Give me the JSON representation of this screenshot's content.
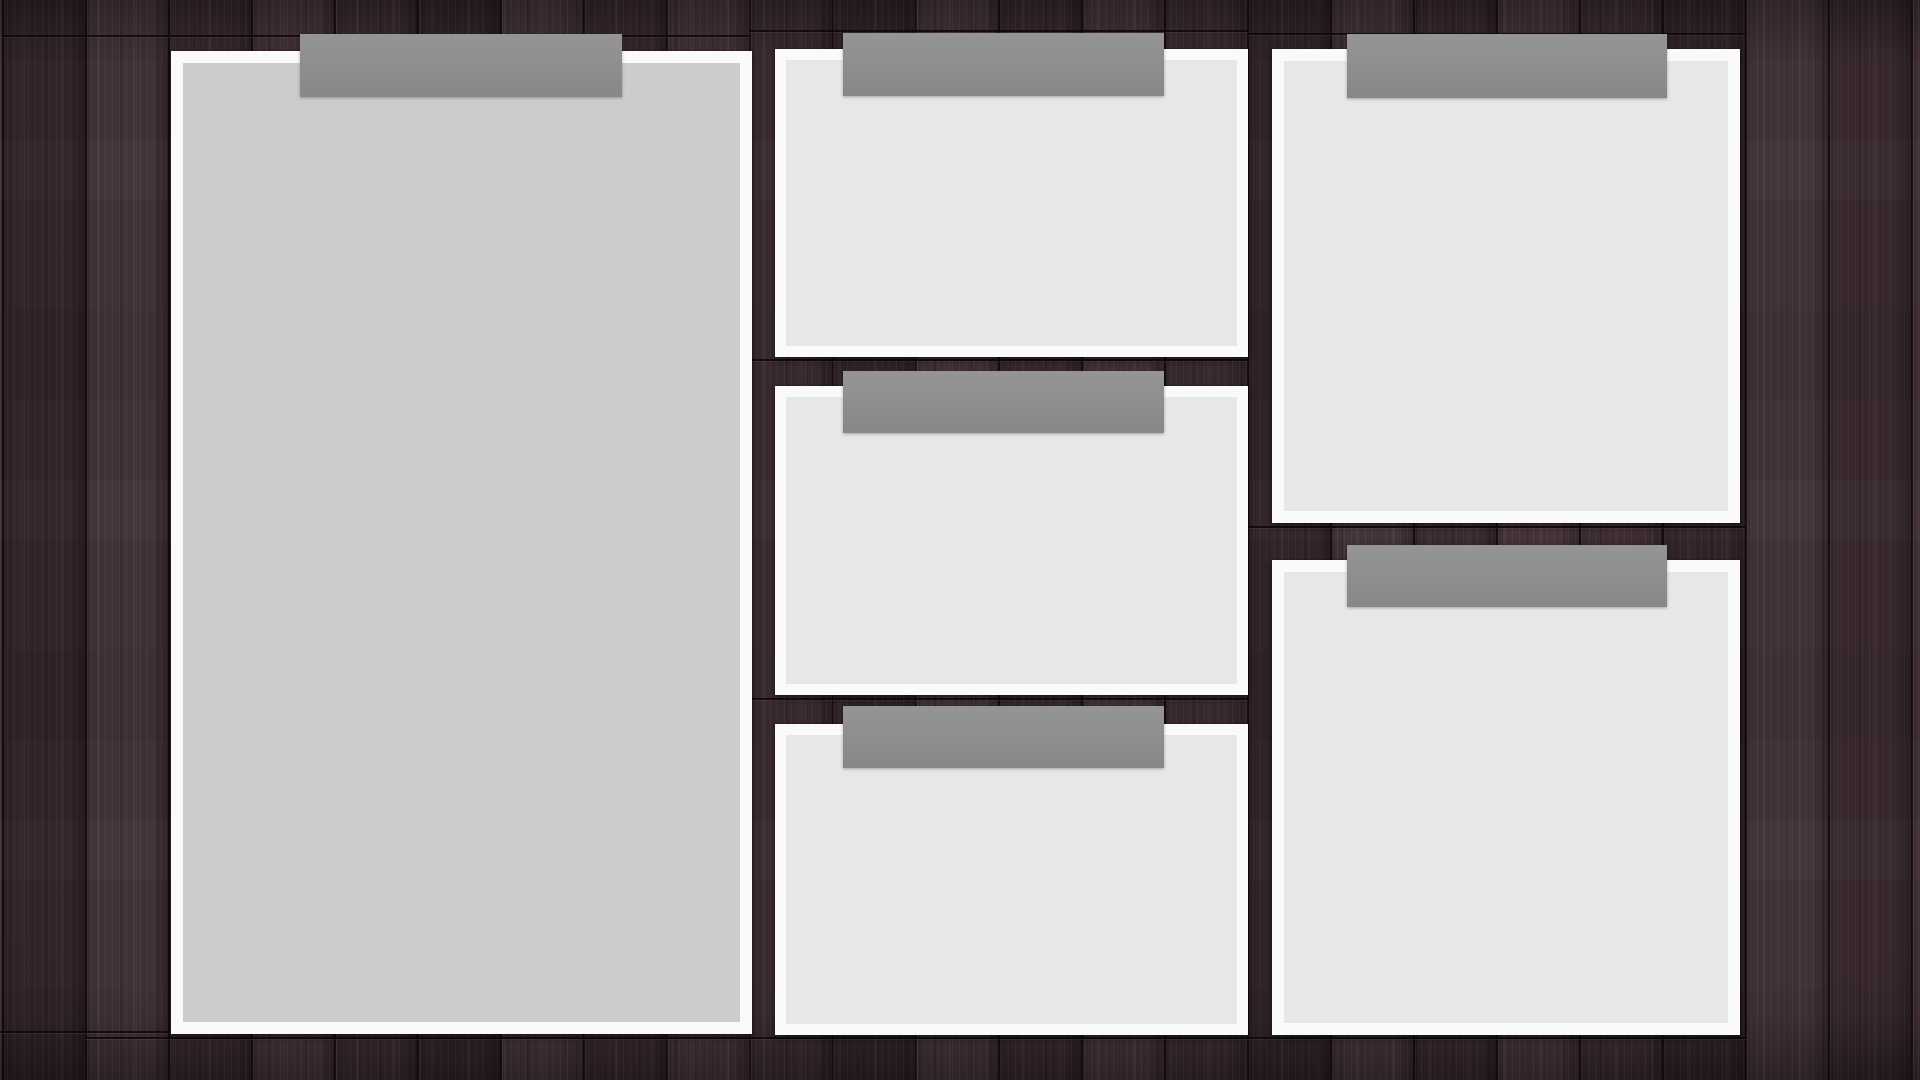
{
  "canvas": {
    "width_px": 1920,
    "height_px": 1080
  },
  "scene": {
    "description": "Six blank paper cards taped with gray tape strips to a dark-brown wood plank board",
    "colors": {
      "wood_base": "#3b2b30",
      "plank_seam": "#140a0d",
      "card_frame": "#fafafa",
      "card_fill_large": "#cdcccc",
      "card_fill_small": "#e8e7e7",
      "tape": "#8f8f8f"
    },
    "plank_width_px": 83,
    "plank_seam_offset_px": 2
  },
  "cards": [
    {
      "name": "card-left-large",
      "x": 171,
      "y": 51,
      "width": 581,
      "height": 983,
      "frame_px": 12,
      "fill": "large",
      "tape": {
        "x": 300,
        "y": 34,
        "width": 322,
        "height": 63
      }
    },
    {
      "name": "card-middle-top",
      "x": 775,
      "y": 49,
      "width": 473,
      "height": 308,
      "frame_px": 11,
      "fill": "small",
      "tape": {
        "x": 843,
        "y": 33,
        "width": 321,
        "height": 63
      }
    },
    {
      "name": "card-middle-center",
      "x": 775,
      "y": 386,
      "width": 473,
      "height": 309,
      "frame_px": 11,
      "fill": "small",
      "tape": {
        "x": 843,
        "y": 371,
        "width": 321,
        "height": 62
      }
    },
    {
      "name": "card-middle-bottom",
      "x": 775,
      "y": 724,
      "width": 473,
      "height": 311,
      "frame_px": 11,
      "fill": "small",
      "tape": {
        "x": 843,
        "y": 706,
        "width": 321,
        "height": 62
      }
    },
    {
      "name": "card-right-top",
      "x": 1272,
      "y": 49,
      "width": 468,
      "height": 474,
      "frame_px": 12,
      "fill": "small",
      "tape": {
        "x": 1347,
        "y": 34,
        "width": 320,
        "height": 64
      }
    },
    {
      "name": "card-right-bottom",
      "x": 1272,
      "y": 560,
      "width": 468,
      "height": 475,
      "frame_px": 12,
      "fill": "small",
      "tape": {
        "x": 1347,
        "y": 545,
        "width": 320,
        "height": 62
      }
    }
  ],
  "wood_seams_horizontal": [
    {
      "x": 2,
      "y": 35,
      "width": 747
    },
    {
      "x": 749,
      "y": 30,
      "width": 499
    },
    {
      "x": 1248,
      "y": 33,
      "width": 497
    },
    {
      "x": 749,
      "y": 359,
      "width": 499
    },
    {
      "x": 749,
      "y": 698,
      "width": 499
    },
    {
      "x": 1248,
      "y": 526,
      "width": 497
    },
    {
      "x": 0,
      "y": 1031,
      "width": 170
    },
    {
      "x": 85,
      "y": 1037,
      "width": 1662
    }
  ]
}
